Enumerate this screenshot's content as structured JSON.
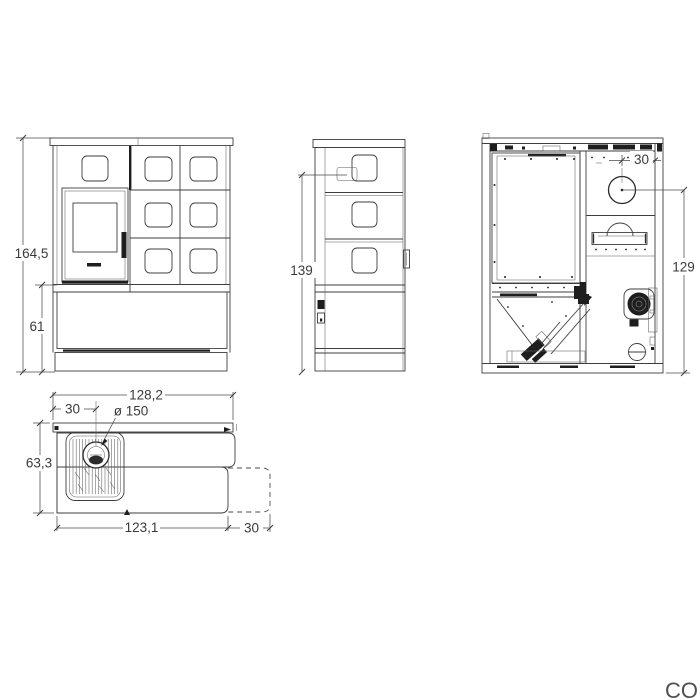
{
  "colors": {
    "background": "#ffffff",
    "line": "#3d3d3d",
    "dark_fill": "#1e1e1e",
    "dim_text": "#3a3a3a"
  },
  "watermark": "CO",
  "views": {
    "front": {
      "dim_total_height": "164,5",
      "dim_base_height": "61"
    },
    "side": {
      "dim_flue_height": "139"
    },
    "rear": {
      "dim_flue_offset": "30",
      "dim_flue_center_height": "129"
    },
    "top": {
      "dim_total_width": "128,2",
      "dim_flue_from_left": "30",
      "dim_flue_diameter": "ø 150",
      "dim_total_depth": "63,3",
      "dim_body_width": "123,1",
      "dim_extension": "30"
    }
  }
}
